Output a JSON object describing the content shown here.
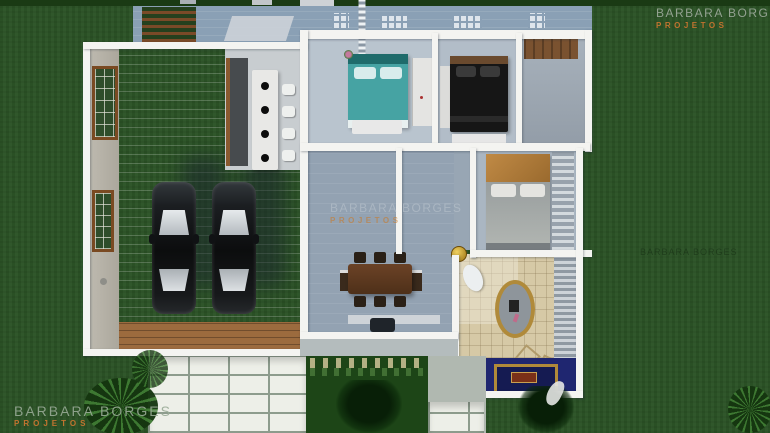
{
  "watermark": {
    "line1": "BARBARA BORGES",
    "line2": "PROJETOS"
  },
  "colors": {
    "grass": "#2c5427",
    "wall": "#f4f4f1",
    "patio": "#8aa0b5",
    "accent_orange": "#c1732f",
    "bed_teal": "#46a3a3",
    "bed_dark": "#161616",
    "tile": "#d6c9a6",
    "navy": "#1f2670",
    "deck": "#9c6b3e",
    "garden": "#1d4517"
  }
}
